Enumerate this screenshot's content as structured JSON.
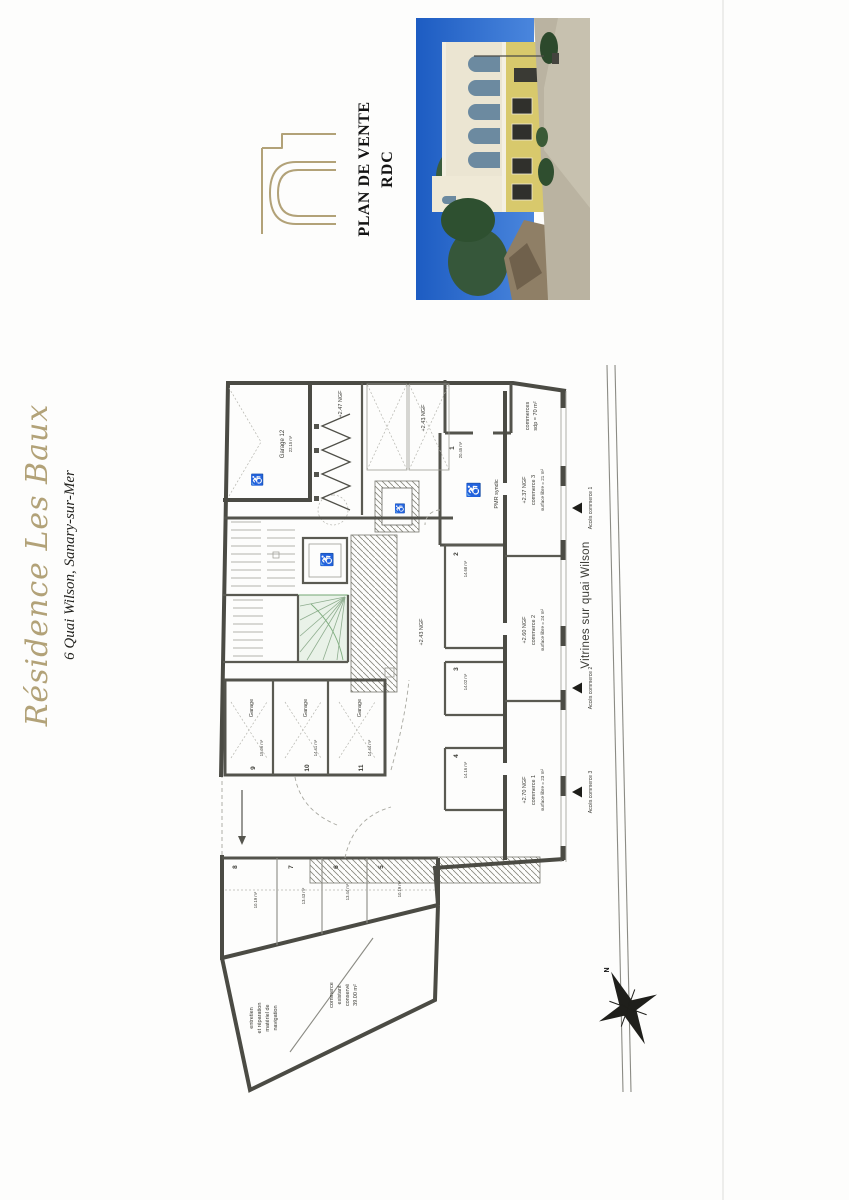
{
  "page": {
    "title": "Résidence Les Baux",
    "subtitle": "6 Quai Wilson, Sanary-sur-Mer"
  },
  "cartouche": {
    "plan_title": "PLAN DE VENTE",
    "level": "RDC"
  },
  "icons": {
    "wheelchair": "♿",
    "north": "N"
  },
  "colors": {
    "gold": "#b2a278",
    "ink": "#1c1c1c",
    "wall": "#4b4b44",
    "stair_green": "#7fae7f",
    "sky_blue": "#2767cd",
    "facade_cream": "#ebe5d2",
    "facade_yellow": "#d8c96c",
    "gravel": "#bab3a1"
  },
  "plan": {
    "vitrines_label": "Vitrines sur quai Wilson",
    "quai_acces": [
      {
        "label": "Accès commerce 1"
      },
      {
        "label": "Accès commerce 2"
      },
      {
        "label": "Accès commerce 3"
      }
    ],
    "commerces_total": {
      "line1": "commerces",
      "line2": "sdp = 70 m²"
    },
    "commerce1": {
      "level": "+2.70 NGF",
      "name": "commerce 1",
      "surface": "surface libre = 23 m²"
    },
    "commerce2": {
      "level": "+2.60 NGF",
      "name": "commerce 2",
      "surface": "surface libre = 24 m²"
    },
    "commerce3": {
      "level": "+2.37 NGF",
      "name": "commerce 3",
      "surface": "surface libre = 21 m²"
    },
    "levels": {
      "corridor": "+2.47 NGF",
      "parking": "+2.43 NGF",
      "hall": "+2.43 NGF"
    },
    "garage12": {
      "name": "Garage 12",
      "area": "22.15 m²"
    },
    "garages": [
      {
        "label": "Garage",
        "num": "9",
        "area": "15.06 m²"
      },
      {
        "label": "Garage",
        "num": "10",
        "area": "14.41 m²"
      },
      {
        "label": "Garage",
        "num": "11",
        "area": "14.44 m²"
      }
    ],
    "pmr_room": {
      "num": "1",
      "area": "20.45 m²",
      "label": "PMR syndic"
    },
    "rooms": [
      {
        "num": "2",
        "area": "14.68 m²"
      },
      {
        "num": "3",
        "area": "14.02 m²"
      },
      {
        "num": "4",
        "area": "14.16 m²"
      },
      {
        "num": "5",
        "area": "10.19 m²"
      },
      {
        "num": "6",
        "area": "13.44 m²"
      },
      {
        "num": "7",
        "area": "13.43 m²"
      },
      {
        "num": "8",
        "area": "10.19 m²"
      }
    ],
    "existing_workshop": {
      "line1": "entretien",
      "line2": "et réparation",
      "line3": "matériel de",
      "line4": "navigation"
    },
    "existing_commerce": {
      "line1": "commerce",
      "line2": "existant",
      "line3": "conservé",
      "line4": "39.00 m²"
    },
    "compass": "N"
  }
}
